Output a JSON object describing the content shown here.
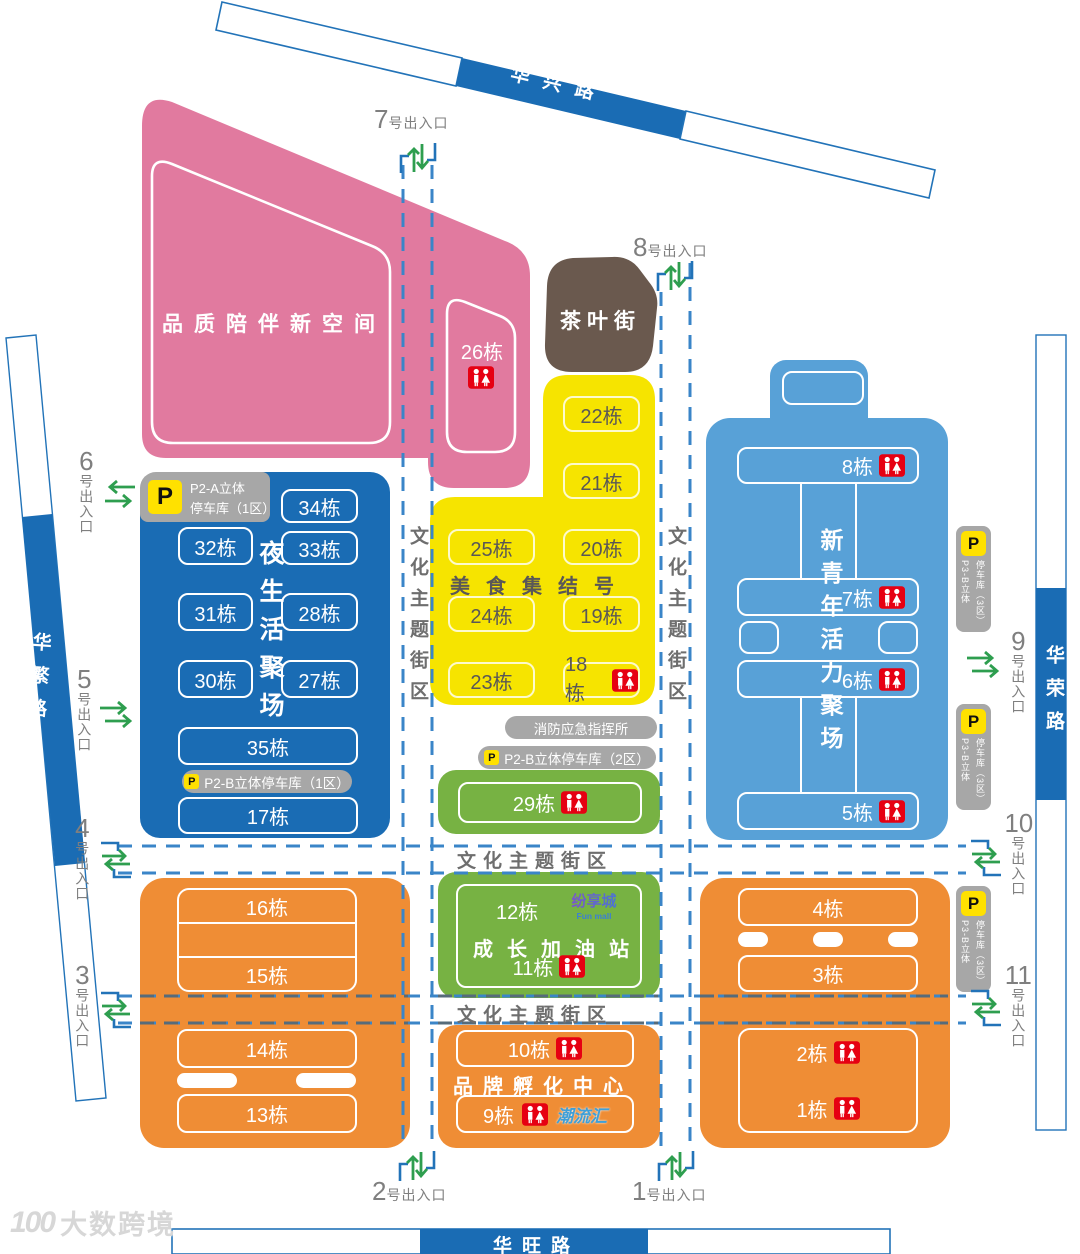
{
  "roads": {
    "top": "华兴路",
    "left": "华繁路",
    "right": "华荣路",
    "bottom": "华旺路"
  },
  "labels": {
    "cultural_street": "文化主题街区",
    "fire_command": "消防应急指挥所"
  },
  "entrances": {
    "suffix": "号出入口",
    "e1": "1",
    "e2": "2",
    "e3": "3",
    "e4": "4",
    "e5": "5",
    "e6": "6",
    "e7": "7",
    "e8": "8",
    "e9": "9",
    "e10": "10",
    "e11": "11"
  },
  "zones": {
    "pink": {
      "name": "品质陪伴新空间",
      "b26": "26栋"
    },
    "tea": {
      "name": "茶叶街"
    },
    "yellow": {
      "name": "美食集结号",
      "b22": "22栋",
      "b21": "21栋",
      "b25": "25栋",
      "b20": "20栋",
      "b24": "24栋",
      "b19": "19栋",
      "b23": "23栋",
      "b18": "18栋"
    },
    "blue_left": {
      "name": "夜生活聚场",
      "b34": "34栋",
      "b33": "33栋",
      "b32": "32栋",
      "b31": "31栋",
      "b28": "28栋",
      "b30": "30栋",
      "b27": "27栋",
      "b35": "35栋",
      "b17": "17栋",
      "parking_a_line1": "P2-A立体",
      "parking_a_line2": "停车库（1区）",
      "parking_b": "P2-B立体停车库（1区）"
    },
    "blue_right": {
      "name": "新青年活力聚场",
      "b8": "8栋",
      "b7": "7栋",
      "b6": "6栋",
      "b5": "5栋"
    },
    "green": {
      "name": "成长加油站",
      "b29": "29栋",
      "b12": "12栋",
      "b11": "11栋",
      "parking": "P2-B立体停车库（2区）",
      "fun_mall_cn": "纷享城",
      "fun_mall_en": "Fun mall"
    },
    "orange": {
      "incubator": "品牌孵化中心",
      "b16": "16栋",
      "b15": "15栋",
      "b14": "14栋",
      "b13": "13栋",
      "b10": "10栋",
      "b9": "9栋",
      "b4": "4栋",
      "b3": "3栋",
      "b2": "2栋",
      "b1": "1栋",
      "chaoliuhui": "潮流汇"
    },
    "parking_p3": {
      "col1": "P3-B立体",
      "col2": "停车库（3区）"
    }
  },
  "icons": {
    "parking": "P",
    "wc": "restroom"
  },
  "watermark": {
    "logo": "100",
    "text": "大数跨境"
  },
  "colors": {
    "pink": "#e17a9f",
    "brown": "#6a594e",
    "yellow": "#f6e400",
    "blue_dark": "#1a6cb4",
    "blue_light": "#58a1d7",
    "green": "#77b243",
    "orange": "#ef8d35",
    "road_blue": "#1a6cb4",
    "dash_blue": "#3a85c8",
    "dash_gray": "#566b7a",
    "wc_red": "#e60012",
    "p_yellow": "#ffe100",
    "sign_gray": "#a7a7a7",
    "entrance_green": "#2e9e4f"
  }
}
